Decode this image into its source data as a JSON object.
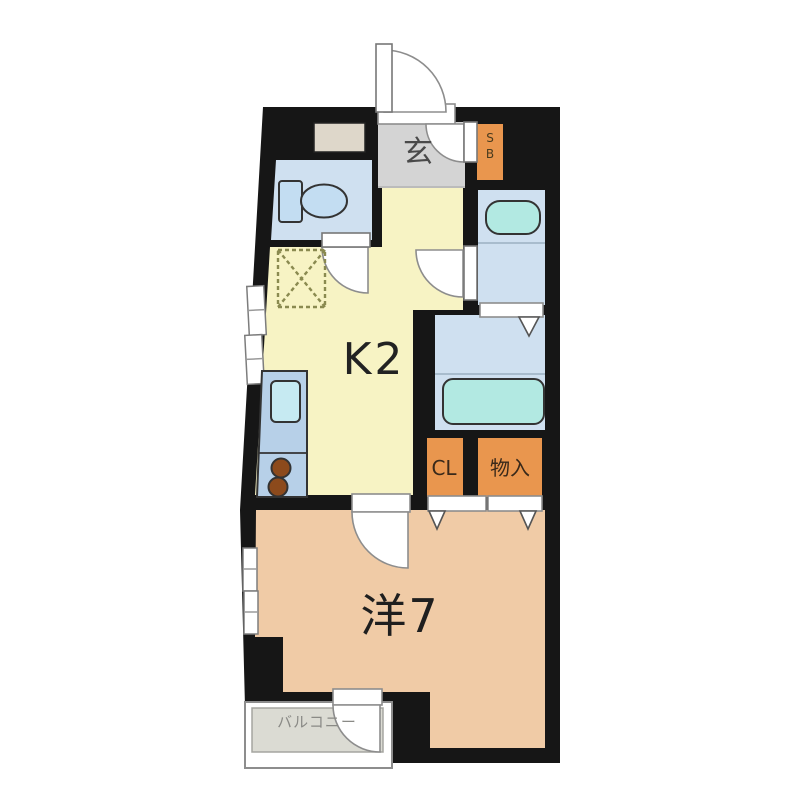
{
  "plan": {
    "rooms": {
      "genkan": {
        "label": "玄"
      },
      "kitchen": {
        "label": "K2"
      },
      "western_room": {
        "label": "洋7"
      },
      "balcony": {
        "label": "バルコニー"
      },
      "shoe_box": {
        "label": "SB"
      },
      "closet": {
        "label": "CL"
      },
      "storage": {
        "label": "物入"
      }
    },
    "colors": {
      "wall": "#161616",
      "kitchen_floor": "#f7f3c4",
      "room_floor": "#f0cba6",
      "wet_floor": "#cfe0f0",
      "genkan_floor": "#d4d4d4",
      "balcony_floor": "#dbdbd3",
      "cabinet": "#e9964e",
      "fixture": "#b2e9e2",
      "sink": "#c6eaf2",
      "toilet": "#c3ddf2",
      "counter": "#b7d0e8",
      "burner": "#8c4a1c",
      "panel": "#ded7ca",
      "door": "#ffffff",
      "label_dark": "#1f1f1f",
      "label_gray": "#4a4a4a",
      "cabinet_text": "#39291a",
      "balcony_text": "#8a8a86"
    }
  }
}
